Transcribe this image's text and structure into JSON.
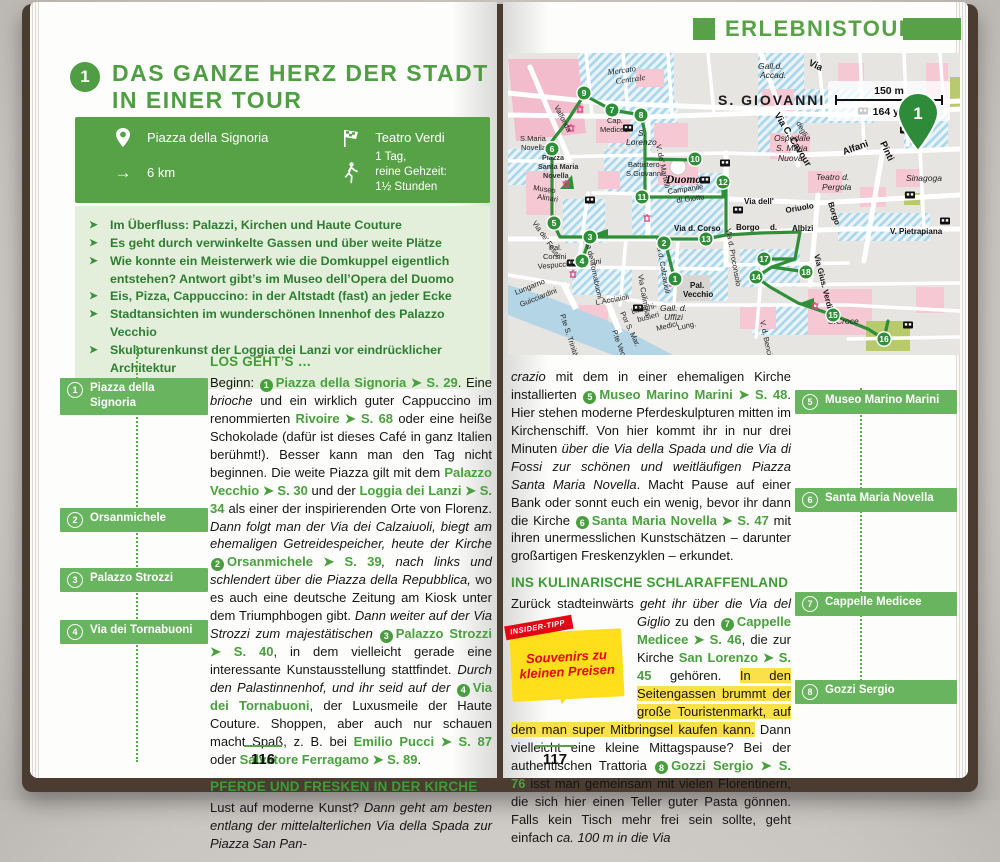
{
  "left_page": {
    "tour_number": "1",
    "title_line1": "DAS GANZE HERZ DER STADT",
    "title_line2": "IN EINER TOUR",
    "info_box": {
      "start_label": "Piazza della Signoria",
      "end_label": "Teatro Verdi",
      "distance": "6 km",
      "duration_lines": [
        "1 Tag,",
        "reine Gehzeit:",
        "1½ Stunden"
      ],
      "icons": {
        "start": "location-pin",
        "end": "finish-flag",
        "distance": "arrow-right",
        "duration": "walking-person"
      }
    },
    "highlights": [
      "Im Überfluss: Palazzi, Kirchen und Haute Couture",
      "Es geht durch verwinkelte Gassen und über weite Plätze",
      "Wie konnte ein Meisterwerk wie die Domkuppel eigentlich entstehen? Antwort gibt’s im Museo dell’Opera del Duomo",
      "Eis, Pizza, Cappuccino: in der Altstadt (fast) an jeder Ecke",
      "Stadtansichten im wunderschönen Innenhof des Palazzo Vecchio",
      "Skulpturenkunst der Loggia dei Lanzi vor eindrücklicher Architektur"
    ],
    "markers": [
      {
        "n": "1",
        "label": "Piazza della Signoria",
        "top": 376,
        "w": 148
      },
      {
        "n": "2",
        "label": "Orsanmichele",
        "top": 506,
        "w": 148
      },
      {
        "n": "3",
        "label": "Palazzo Strozzi",
        "top": 566,
        "w": 148
      },
      {
        "n": "4",
        "label": "Via dei Tornabuoni",
        "top": 618,
        "w": 148
      }
    ],
    "section1_heading": "LOS GEHT’S …",
    "para1": [
      {
        "s": "pl",
        "t": "Beginn: "
      },
      {
        "s": "c",
        "t": "1"
      },
      {
        "s": "lk",
        "t": "Piazza della Signoria ➤ S. 29"
      },
      {
        "s": "pl",
        "t": ". Eine "
      },
      {
        "s": "it",
        "t": "brioche"
      },
      {
        "s": "pl",
        "t": " und ein wirklich guter Cappuccino im renommierten "
      },
      {
        "s": "lk",
        "t": "Rivoire ➤ S. 68"
      },
      {
        "s": "pl",
        "t": " oder eine heiße Schokolade (dafür ist dieses Café in ganz Italien berühmt!). Besser kann man den Tag nicht beginnen. Die weite Piazza gilt mit dem "
      },
      {
        "s": "lk",
        "t": "Palazzo Vecchio ➤ S. 30"
      },
      {
        "s": "pl",
        "t": " und der "
      },
      {
        "s": "lk",
        "t": "Loggia dei Lanzi ➤ S. 34"
      },
      {
        "s": "pl",
        "t": " als einer der inspirierenden Orte von Florenz. "
      },
      {
        "s": "it",
        "t": "Dann folgt man der Via dei Calzaiuoli, biegt am ehemaligen Getreidespeicher, heute der Kirche "
      },
      {
        "s": "c",
        "t": "2"
      },
      {
        "s": "lk",
        "t": "Orsanmichele ➤ S. 39"
      },
      {
        "s": "it",
        "t": ", nach links und schlendert über die Piazza della Repubblica,"
      },
      {
        "s": "pl",
        "t": " wo es auch eine deutsche Zeitung am Kiosk unter dem Triumphbogen gibt. "
      },
      {
        "s": "it",
        "t": "Dann weiter auf der Via Strozzi zum majestätischen "
      },
      {
        "s": "c",
        "t": "3"
      },
      {
        "s": "lk",
        "t": "Palazzo Strozzi ➤ S. 40"
      },
      {
        "s": "pl",
        "t": ", in dem vielleicht gerade eine interessante Kunstausstellung stattfindet. "
      },
      {
        "s": "it",
        "t": "Durch den Palastinnenhof, und ihr seid auf der "
      },
      {
        "s": "c",
        "t": "4"
      },
      {
        "s": "lk",
        "t": "Via dei Tornabuoni"
      },
      {
        "s": "pl",
        "t": ", der Luxusmeile der Haute Couture. Shoppen, aber auch nur schauen macht Spaß, z. B. bei "
      },
      {
        "s": "lk",
        "t": "Emilio Pucci ➤ S. 87"
      },
      {
        "s": "pl",
        "t": " oder "
      },
      {
        "s": "lk",
        "t": "Salvatore Ferragamo ➤ S. 89"
      },
      {
        "s": "pl",
        "t": "."
      }
    ],
    "section2_heading": "PFERDE UND FRESKEN IN DER KIRCHE",
    "para2": [
      {
        "s": "pl",
        "t": "Lust auf moderne Kunst? "
      },
      {
        "s": "it",
        "t": "Dann geht am besten entlang der mittelalterlichen Via della Spada zur Piazza San Pan-"
      }
    ],
    "page_number": "116"
  },
  "right_page": {
    "header": "ERLEBNISTOUREN",
    "map": {
      "district": "S. GIOVANNI",
      "scale_metric": "150 m",
      "scale_imperial": "164 yd",
      "pin_label": "1",
      "labels": [
        {
          "t": "Mercato",
          "x": 100,
          "y": 22,
          "r": -8,
          "c": "i"
        },
        {
          "t": "Centrale",
          "x": 108,
          "y": 31,
          "r": -8,
          "c": "i"
        },
        {
          "t": "Valfonda",
          "x": 46,
          "y": 54,
          "r": 62,
          "c": "s"
        },
        {
          "t": "S.Maria",
          "x": 12,
          "y": 88,
          "r": 0,
          "c": "s"
        },
        {
          "t": "Novella",
          "x": 13,
          "y": 97,
          "r": 0,
          "c": "s"
        },
        {
          "t": "Piazza",
          "x": 34,
          "y": 107,
          "r": 0,
          "c": "b7"
        },
        {
          "t": "Santa Maria",
          "x": 30,
          "y": 116,
          "r": 0,
          "c": "b7"
        },
        {
          "t": "Novella",
          "x": 35,
          "y": 125,
          "r": 0,
          "c": "b7"
        },
        {
          "t": "Museo",
          "x": 25,
          "y": 137,
          "r": 8,
          "c": "s"
        },
        {
          "t": "Alinari",
          "x": 29,
          "y": 146,
          "r": 8,
          "c": "s"
        },
        {
          "t": "Cap.",
          "x": 99,
          "y": 70,
          "r": 0,
          "c": "s"
        },
        {
          "t": "Medicee",
          "x": 92,
          "y": 79,
          "r": 0,
          "c": "s"
        },
        {
          "t": "S.",
          "x": 130,
          "y": 83,
          "r": 0,
          "c": "i9"
        },
        {
          "t": "Lorenzo",
          "x": 118,
          "y": 92,
          "r": 0,
          "c": "i9"
        },
        {
          "t": "Battistero",
          "x": 120,
          "y": 114,
          "r": 0,
          "c": "s"
        },
        {
          "t": "S.Giovanni",
          "x": 118,
          "y": 123,
          "r": 0,
          "c": "s"
        },
        {
          "t": "Duomo",
          "x": 158,
          "y": 130,
          "r": 0,
          "c": "duomo"
        },
        {
          "t": "Campanile",
          "x": 160,
          "y": 141,
          "r": -8,
          "c": "s"
        },
        {
          "t": "di Giotto",
          "x": 169,
          "y": 150,
          "r": -8,
          "c": "s"
        },
        {
          "t": "V. de' Martelli",
          "x": 148,
          "y": 92,
          "r": 78,
          "c": "s"
        },
        {
          "t": "Via C. Cavour",
          "x": 266,
          "y": 62,
          "r": 58,
          "c": "B"
        },
        {
          "t": "Via",
          "x": 300,
          "y": 12,
          "r": 25,
          "c": "B"
        },
        {
          "t": "S. GIOVANNI",
          "x": 210,
          "y": 52,
          "r": 0,
          "c": "big"
        },
        {
          "t": "Gall.d.",
          "x": 250,
          "y": 16,
          "r": 0,
          "c": "i9"
        },
        {
          "t": "Accad.",
          "x": 252,
          "y": 25,
          "r": 0,
          "c": "i9"
        },
        {
          "t": "degli",
          "x": 288,
          "y": 70,
          "r": 62,
          "c": "s"
        },
        {
          "t": "Ospedale",
          "x": 266,
          "y": 88,
          "r": 0,
          "c": "i9"
        },
        {
          "t": "S. Maria",
          "x": 268,
          "y": 98,
          "r": 0,
          "c": "i9"
        },
        {
          "t": "Nuova",
          "x": 270,
          "y": 108,
          "r": 0,
          "c": "i9"
        },
        {
          "t": "Alfani",
          "x": 336,
          "y": 102,
          "r": -20,
          "c": "B"
        },
        {
          "t": "Pinti",
          "x": 372,
          "y": 90,
          "r": 65,
          "c": "B"
        },
        {
          "t": "Teatro d.",
          "x": 308,
          "y": 127,
          "r": 0,
          "c": "i9"
        },
        {
          "t": "Pergola",
          "x": 314,
          "y": 137,
          "r": 0,
          "c": "i9"
        },
        {
          "t": "Sinagoga",
          "x": 398,
          "y": 128,
          "r": 0,
          "c": "i9"
        },
        {
          "t": "Via dell'",
          "x": 236,
          "y": 151,
          "r": 0,
          "c": "b"
        },
        {
          "t": "Oriuolo",
          "x": 278,
          "y": 160,
          "r": -10,
          "c": "b"
        },
        {
          "t": "Borgo",
          "x": 320,
          "y": 150,
          "r": 72,
          "c": "b"
        },
        {
          "t": "Borgo",
          "x": 228,
          "y": 177,
          "r": 0,
          "c": "b"
        },
        {
          "t": "d.",
          "x": 262,
          "y": 177,
          "r": 0,
          "c": "b"
        },
        {
          "t": "Albizi",
          "x": 284,
          "y": 178,
          "r": 0,
          "c": "b"
        },
        {
          "t": "V. Pietrapiana",
          "x": 382,
          "y": 181,
          "r": 0,
          "c": "b"
        },
        {
          "t": "Via Gius. Verdi",
          "x": 306,
          "y": 202,
          "r": 76,
          "c": "b"
        },
        {
          "t": "Via d. Corso",
          "x": 166,
          "y": 178,
          "r": 0,
          "c": "b"
        },
        {
          "t": "Via d. Proconsolo",
          "x": 218,
          "y": 176,
          "r": 80,
          "c": "s"
        },
        {
          "t": "Via d. Calzaiuoli",
          "x": 148,
          "y": 188,
          "r": 80,
          "c": "s"
        },
        {
          "t": "Via Calimala",
          "x": 130,
          "y": 222,
          "r": 80,
          "c": "s"
        },
        {
          "t": "Por S. Mar.",
          "x": 112,
          "y": 260,
          "r": 65,
          "c": "s"
        },
        {
          "t": "Via de' Tornabuoni",
          "x": 77,
          "y": 186,
          "r": 78,
          "c": "s"
        },
        {
          "t": "Via de' Fossi",
          "x": 24,
          "y": 170,
          "r": 55,
          "c": "s"
        },
        {
          "t": "Pal.",
          "x": 41,
          "y": 197,
          "r": 0,
          "c": "s"
        },
        {
          "t": "Corsini",
          "x": 35,
          "y": 206,
          "r": 0,
          "c": "s"
        },
        {
          "t": "Vespucci L. Corsini",
          "x": 30,
          "y": 216,
          "r": -5,
          "c": "s"
        },
        {
          "t": "Lungarno",
          "x": 8,
          "y": 242,
          "r": -22,
          "c": "s"
        },
        {
          "t": "Guicciardini",
          "x": 13,
          "y": 254,
          "r": -22,
          "c": "s"
        },
        {
          "t": "P.te S. Trinità",
          "x": 52,
          "y": 262,
          "r": 72,
          "c": "s"
        },
        {
          "t": "L.Acciaioli",
          "x": 88,
          "y": 252,
          "r": -10,
          "c": "s"
        },
        {
          "t": "P.te Vecchio",
          "x": 104,
          "y": 278,
          "r": 70,
          "c": "s"
        },
        {
          "t": "L.Archi-",
          "x": 124,
          "y": 261,
          "r": -14,
          "c": "s"
        },
        {
          "t": "busieri",
          "x": 130,
          "y": 269,
          "r": -14,
          "c": "s"
        },
        {
          "t": "Medici",
          "x": 149,
          "y": 278,
          "r": -14,
          "c": "s"
        },
        {
          "t": "Pal.",
          "x": 182,
          "y": 235,
          "r": 0,
          "c": "b"
        },
        {
          "t": "Vecchio",
          "x": 175,
          "y": 244,
          "r": 0,
          "c": "b"
        },
        {
          "t": "Gall. d.",
          "x": 152,
          "y": 258,
          "r": 0,
          "c": "i9"
        },
        {
          "t": "Uffizi",
          "x": 156,
          "y": 267,
          "r": 0,
          "c": "i9"
        },
        {
          "t": "Lung.",
          "x": 170,
          "y": 277,
          "r": -12,
          "c": "s"
        },
        {
          "t": "S.Croce",
          "x": 320,
          "y": 271,
          "r": 0,
          "c": "i9"
        },
        {
          "t": "V. d. Benci",
          "x": 252,
          "y": 268,
          "r": 78,
          "c": "s"
        }
      ],
      "stops": [
        {
          "n": "1",
          "x": 167,
          "y": 226
        },
        {
          "n": "2",
          "x": 156,
          "y": 190
        },
        {
          "n": "3",
          "x": 82,
          "y": 184
        },
        {
          "n": "4",
          "x": 74,
          "y": 208
        },
        {
          "n": "5",
          "x": 46,
          "y": 170
        },
        {
          "n": "6",
          "x": 44,
          "y": 96
        },
        {
          "n": "7",
          "x": 104,
          "y": 57
        },
        {
          "n": "8",
          "x": 133,
          "y": 62
        },
        {
          "n": "9",
          "x": 76,
          "y": 40
        },
        {
          "n": "10",
          "x": 187,
          "y": 106
        },
        {
          "n": "11",
          "x": 134,
          "y": 144
        },
        {
          "n": "12",
          "x": 215,
          "y": 129
        },
        {
          "n": "13",
          "x": 198,
          "y": 186
        },
        {
          "n": "14",
          "x": 248,
          "y": 224
        },
        {
          "n": "15",
          "x": 325,
          "y": 262
        },
        {
          "n": "16",
          "x": 376,
          "y": 286
        },
        {
          "n": "17",
          "x": 256,
          "y": 206
        },
        {
          "n": "18",
          "x": 298,
          "y": 219
        }
      ],
      "transit_icons": [
        {
          "x": 120,
          "y": 75
        },
        {
          "x": 355,
          "y": 58
        },
        {
          "x": 397,
          "y": 77
        },
        {
          "x": 217,
          "y": 110
        },
        {
          "x": 197,
          "y": 127
        },
        {
          "x": 230,
          "y": 157
        },
        {
          "x": 82,
          "y": 147
        },
        {
          "x": 64,
          "y": 210
        },
        {
          "x": 130,
          "y": 255
        },
        {
          "x": 402,
          "y": 142
        },
        {
          "x": 400,
          "y": 272
        },
        {
          "x": 437,
          "y": 168
        }
      ],
      "monument_icons": [
        {
          "x": 63,
          "y": 75
        },
        {
          "x": 58,
          "y": 131
        },
        {
          "x": 65,
          "y": 221
        },
        {
          "x": 139,
          "y": 165
        },
        {
          "x": 307,
          "y": 253
        },
        {
          "x": 164,
          "y": 230
        },
        {
          "x": 72,
          "y": 56
        }
      ]
    },
    "para1": [
      {
        "s": "it",
        "t": "crazio"
      },
      {
        "s": "pl",
        "t": " mit dem in einer ehemaligen Kirche installierten "
      },
      {
        "s": "c",
        "t": "5"
      },
      {
        "s": "lk",
        "t": "Museo Marino Marini ➤ S. 48"
      },
      {
        "s": "pl",
        "t": ". Hier stehen moderne Pferdeskulpturen mitten im Kirchenschiff. Von hier kommt ihr in nur drei Minuten "
      },
      {
        "s": "it",
        "t": "über die Via della Spada und die Via di Fossi zur schönen und weitläufigen Piazza Santa Maria Novella"
      },
      {
        "s": "pl",
        "t": ". Macht Pause auf einer Bank oder sonnt euch ein wenig, bevor ihr dann die Kirche "
      },
      {
        "s": "c",
        "t": "6"
      },
      {
        "s": "lk",
        "t": "Santa Maria Novella ➤ S. 47"
      },
      {
        "s": "pl",
        "t": " mit ihren unermesslichen Kunstschätzen – darunter großartigen Freskenzyklen – erkundet."
      }
    ],
    "section_heading": "INS KULINARISCHE SCHLARAFFENLAND",
    "insider_tip": {
      "tab": "INSIDER-TIPP",
      "text": "Souvenirs zu kleinen Preisen"
    },
    "para2": [
      {
        "s": "pl",
        "t": "Zurück stadteinwärts "
      },
      {
        "s": "it",
        "t": "geht ihr über die Via del Giglio"
      },
      {
        "s": "pl",
        "t": " zu "
      },
      {
        "s": "tip",
        "t": ""
      },
      {
        "s": "pl",
        "t": "den "
      },
      {
        "s": "c",
        "t": "7"
      },
      {
        "s": "lk",
        "t": "Cappelle Medicee ➤ S. 46"
      },
      {
        "s": "pl",
        "t": ", die zur Kirche "
      },
      {
        "s": "lk",
        "t": "San Lorenzo ➤ S. 45"
      },
      {
        "s": "pl",
        "t": " gehören. "
      },
      {
        "s": "hl",
        "t": "In den Seitengassen brummt der große Touristenmarkt, auf dem man super Mitbringsel kaufen kann."
      },
      {
        "s": "pl",
        "t": " Dann vielleicht eine kleine Mittagspause? Bei der authentischen Trattoria "
      },
      {
        "s": "c",
        "t": "8"
      },
      {
        "s": "lk",
        "t": "Gozzi Sergio ➤ S. 76"
      },
      {
        "s": "pl",
        "t": " isst man gemeinsam mit vielen Florentinern, die sich hier einen Teller guter Pasta gönnen. Falls kein Tisch mehr frei sein sollte, geht einfach "
      },
      {
        "s": "it",
        "t": "ca. 100 m in die Via"
      }
    ],
    "markers": [
      {
        "n": "5",
        "label": "Museo Marino Marini",
        "top": 388,
        "w": 162
      },
      {
        "n": "6",
        "label": "Santa Maria Novella",
        "top": 486,
        "w": 162
      },
      {
        "n": "7",
        "label": "Cappelle Medicee",
        "top": 590,
        "w": 162
      },
      {
        "n": "8",
        "label": "Gozzi Sergio",
        "top": 678,
        "w": 162
      }
    ],
    "page_number": "117"
  }
}
